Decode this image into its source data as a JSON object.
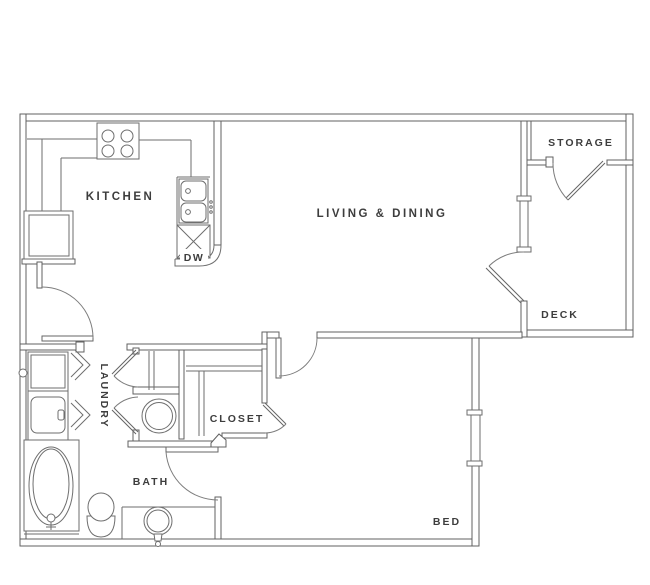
{
  "plan": {
    "type": "apartment-floor-plan",
    "palette": {
      "background": "#ffffff",
      "wall_line": "#616161",
      "thin_line": "#6e6e6e",
      "door_arc": "#7d7d7d",
      "text": "#3d3d3d"
    },
    "labels": {
      "kitchen": "KITCHEN",
      "living_dining": "LIVING & DINING",
      "storage": "STORAGE",
      "deck": "DECK",
      "laundry": "LAUNDRY",
      "closet": "CLOSET",
      "bath": "BATH",
      "bed": "BED",
      "dishwasher": "DW"
    },
    "fixtures": [
      "stove-icon",
      "kitchen-sink-icon",
      "dishwasher-icon",
      "refrigerator-icon",
      "washer-dryer-icon",
      "water-heater-icon",
      "bathtub-icon",
      "toilet-icon",
      "vanity-sink-icon",
      "window-symbol",
      "door-swing-symbol",
      "bifold-door-symbol"
    ]
  }
}
